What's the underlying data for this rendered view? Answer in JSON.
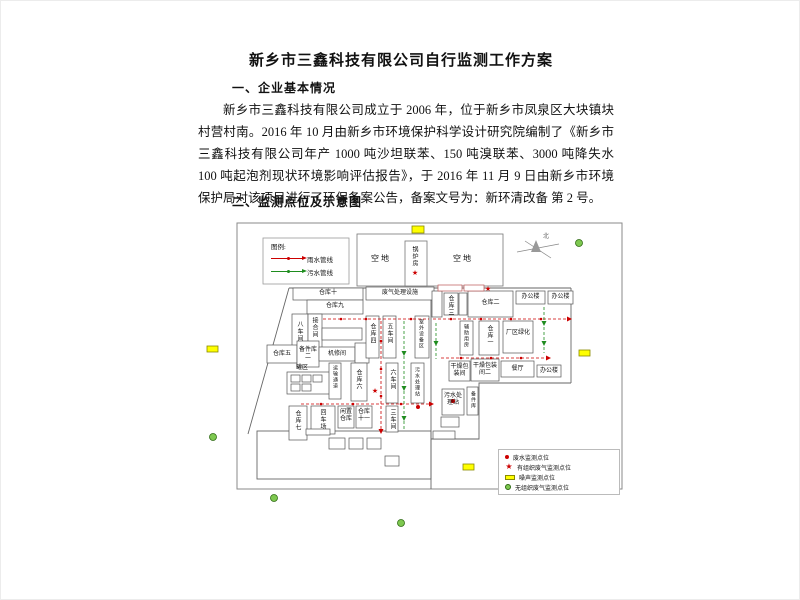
{
  "doc": {
    "title": "新乡市三鑫科技有限公司自行监测工作方案",
    "section1": {
      "heading": "一、企业基本情况",
      "lines": [
        "新乡市三鑫科技有限公司成立于 2006 年，位于新乡市凤泉区大块镇块",
        "村营村南。2016 年 10 月由新乡市环境保护科学设计研究院编制了《新乡市",
        "三鑫科技有限公司年产 1000 吨沙坦联苯、150 吨溴联苯、3000 吨降失水剂、",
        "100 吨起泡剂现状环境影响评估报告》，于 2016 年 11 月 9 日由新乡市环境",
        "保护局对该项目进行了环保备案公告，备案文号为：新环清改备 第 2 号。"
      ]
    },
    "section2": {
      "heading": "二、监测点位及示意图"
    }
  },
  "diagram": {
    "legend": {
      "title": "图例:",
      "rain": "雨水管线",
      "sewage": "污水管线"
    },
    "compass": "北",
    "star_glyph": "★",
    "labels": {
      "kongdi1": "空地",
      "kongdi2": "空地",
      "guolufang": "锅炉房",
      "feiqi": "废气处理设施",
      "cangku10": "仓库十",
      "cangku9": "仓库九",
      "bachejian": "八车间",
      "jiehejian": "接合间",
      "cangku5": "仓库五",
      "beijianku2": "备件库二",
      "jixiujian": "机修间",
      "guanqu": "罐区",
      "yunshu": "运输通道",
      "cangku4": "仓库四",
      "wuchejian": "五车间",
      "shiwai": "室外设备区",
      "cangku6": "仓库六",
      "liuchejian": "六车间",
      "wushui1": "污水处理站",
      "cangku7": "仓库七",
      "huiche": "回车场",
      "xianzhi": "闲置仓库",
      "cangku11": "仓库十一",
      "sanchejian": "三车间",
      "cangku3": "仓库三",
      "cangku2": "仓库二",
      "bangong1": "办公楼",
      "bangong2": "办公楼",
      "fuzhu": "辅助用房",
      "cangku1": "仓库一",
      "lvhua": "厂区绿化",
      "ganzao1": "干燥包装间",
      "ganzao2": "干燥包装间二",
      "canting": "餐厅",
      "bangong3": "办公楼",
      "wushui2": "污水处理站",
      "beijianku": "备件库"
    },
    "monitor_legend": {
      "wastewater": "废水监测点位",
      "organized_gas": "有组织废气监测点位",
      "noise": "噪声监测点位",
      "fugitive_gas": "无组织废气监测点位"
    },
    "colors": {
      "rain_line": "#cc0000",
      "sewage_line": "#1e8c1e",
      "noise_marker": "#ffff00",
      "fugitive_marker": "#7ec850",
      "organized_marker": "#cc0000",
      "wastewater_marker": "#cc0000"
    }
  }
}
